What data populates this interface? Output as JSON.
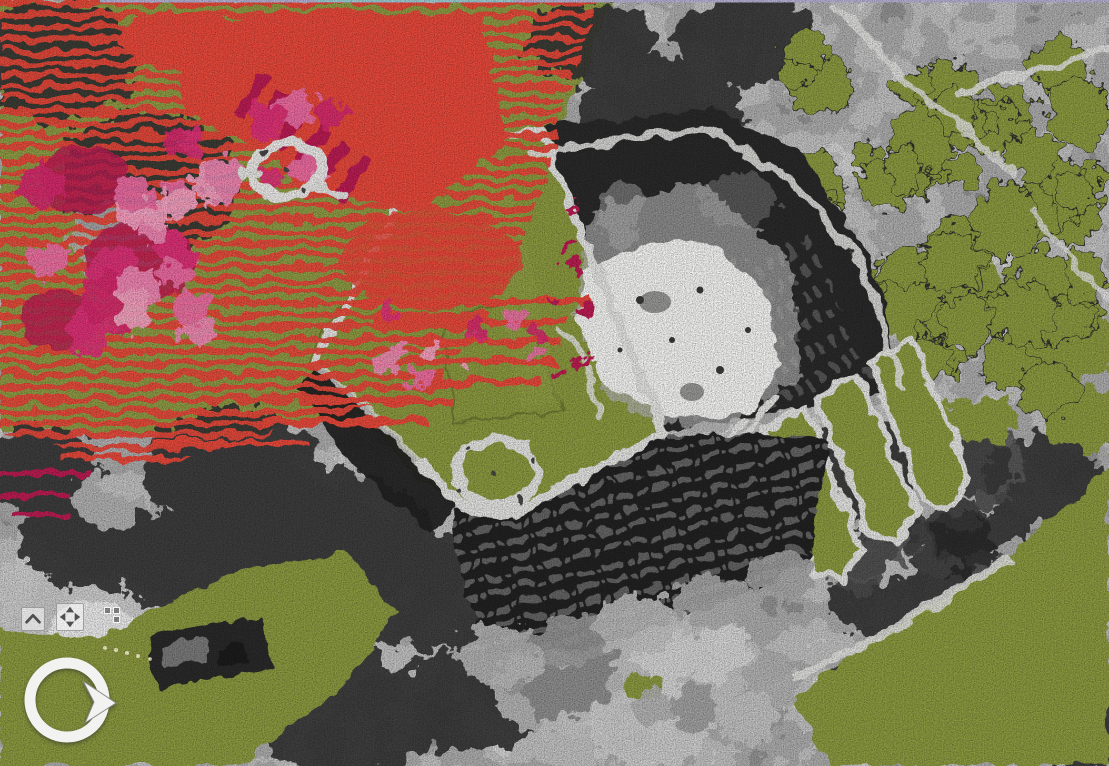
{
  "viewport": {
    "width": 1109,
    "height": 766
  },
  "palette": {
    "base_gray": "#8e8e8e",
    "olive": "#8c9a41",
    "olive_edge": "#6f7a2e",
    "red": "#e8483b",
    "crimson": "#bb1e53",
    "pink": "#ef6fa8",
    "magenta": "#e0337a",
    "pink_light": "#f8a6c8",
    "white_path": "#e4e4e2",
    "plaza": "#f4f4f3",
    "facade": "#232323",
    "window": "#7a7a7a",
    "tree_dark": "#343434",
    "tree_light": "#c9c9c9",
    "ground_light": "#ababab",
    "sky": "#b7b3d6",
    "sky_cyan": "#9ccfd4",
    "ui_glyph": "#4f4f4f",
    "ui_bg": "rgba(255,255,255,0.52)",
    "ui_border": "rgba(105,105,105,0.55)",
    "cycles": {
      "blob-olive": [
        "#8c9a41"
      ],
      "blob-pink": [
        "#ef6fa8",
        "#e0337a",
        "#f8a6c8",
        "#d62a6e",
        "#f28cba"
      ],
      "blob-crimson": [
        "#bb1e53",
        "#a81a49"
      ],
      "blob-graylight": [
        "#c4c4c4",
        "#9e9e9e",
        "#d8d8d8",
        "#8a8a8a",
        "#b2b2b2"
      ],
      "blob-graydark": [
        "#3a3a3a",
        "#4e4e4e",
        "#2c2c2c",
        "#5a5a5a",
        "#444444"
      ]
    }
  },
  "ui": {
    "buttons": [
      {
        "id": "collapse",
        "icon": "chevron-up-icon"
      },
      {
        "id": "pan",
        "icon": "pan-arrows-icon"
      },
      {
        "id": "grid",
        "icon": "grid-squares-icon"
      }
    ],
    "compass": {
      "icon": "rotation-compass-icon"
    }
  },
  "scene": {
    "type": "aerial-lidar-point-cloud-3d",
    "overlay_classes": [
      {
        "name": "selection-ground",
        "style": "horizontal-red-stripes",
        "color": "#e8483b"
      },
      {
        "name": "selection-vegetation",
        "style": "pink-magenta-blobs",
        "color": "#ef6fa8"
      },
      {
        "name": "classified-surface",
        "style": "solid",
        "color": "#8c9a41"
      },
      {
        "name": "intensity-points",
        "style": "grayscale",
        "color": "#8e8e8e"
      }
    ],
    "blob_fields": [
      {
        "name": "treetops-olive-ne",
        "class": "blob-olive",
        "x": 778,
        "y": 2,
        "w": 331,
        "h": 350,
        "count": 46,
        "rmin": 13,
        "rmax": 36,
        "seed": 7
      },
      {
        "name": "treetops-olive-ne2",
        "class": "blob-olive",
        "x": 905,
        "y": 250,
        "w": 204,
        "h": 170,
        "count": 10,
        "rmin": 18,
        "rmax": 42,
        "seed": 12
      },
      {
        "name": "trees-gray-right",
        "class": "blob-graydark",
        "x": 820,
        "y": 420,
        "w": 240,
        "h": 200,
        "count": 12,
        "rmin": 20,
        "rmax": 45,
        "seed": 17
      },
      {
        "name": "trees-gray-bottom",
        "class": "blob-graylight",
        "x": 460,
        "y": 600,
        "w": 360,
        "h": 150,
        "count": 14,
        "rmin": 18,
        "rmax": 40,
        "seed": 21
      },
      {
        "name": "selection-pink-a",
        "class": "blob-pink",
        "x": 20,
        "y": 165,
        "w": 200,
        "h": 200,
        "count": 16,
        "rmin": 10,
        "rmax": 26,
        "seed": 3
      },
      {
        "name": "selection-pink-b",
        "class": "blob-pink",
        "x": 160,
        "y": 60,
        "w": 190,
        "h": 170,
        "count": 13,
        "rmin": 9,
        "rmax": 22,
        "seed": 5
      },
      {
        "name": "selection-pink-c",
        "class": "blob-pink",
        "x": 300,
        "y": 300,
        "w": 260,
        "h": 100,
        "count": 11,
        "rmin": 6,
        "rmax": 13,
        "seed": 9
      },
      {
        "name": "selection-crimson-dots",
        "class": "blob-crimson",
        "x": 548,
        "y": 190,
        "w": 50,
        "h": 230,
        "count": 9,
        "rmin": 3,
        "rmax": 7,
        "seed": 4
      }
    ]
  }
}
